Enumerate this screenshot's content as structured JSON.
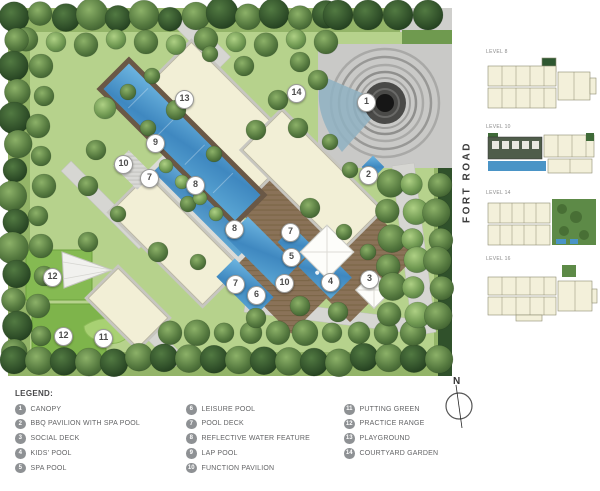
{
  "palette": {
    "pool_blue": "#4a94c8",
    "lawn_green": "#b6d28c",
    "tree_dark_green": "#2d4a26",
    "building_cream": "#f2efd6",
    "deck_brown": "#8a7258",
    "path_gray": "#d6d6d2",
    "legend_circle_gray": "#8e9194"
  },
  "plan": {
    "fort_road_label": "FORT ROAD",
    "markers": [
      {
        "n": "1"
      },
      {
        "n": "2"
      },
      {
        "n": "3"
      },
      {
        "n": "4"
      },
      {
        "n": "5"
      },
      {
        "n": "6"
      },
      {
        "n": "7"
      },
      {
        "n": "7"
      },
      {
        "n": "7"
      },
      {
        "n": "8"
      },
      {
        "n": "8"
      },
      {
        "n": "9"
      },
      {
        "n": "10"
      },
      {
        "n": "10"
      },
      {
        "n": "11"
      },
      {
        "n": "12"
      },
      {
        "n": "12"
      },
      {
        "n": "13"
      },
      {
        "n": "14"
      }
    ]
  },
  "floorplans": {
    "items": [
      {
        "label": "LEVEL 8"
      },
      {
        "label": "LEVEL 10"
      },
      {
        "label": "LEVEL 14"
      },
      {
        "label": "LEVEL 16"
      }
    ]
  },
  "legend": {
    "title": "LEGEND:",
    "items": [
      {
        "num": "1",
        "label": "CANOPY"
      },
      {
        "num": "2",
        "label": "BBQ PAVILION WITH SPA POOL"
      },
      {
        "num": "3",
        "label": "SOCIAL DECK"
      },
      {
        "num": "4",
        "label": "KIDS' POOL"
      },
      {
        "num": "5",
        "label": "SPA POOL"
      },
      {
        "num": "6",
        "label": "LEISURE POOL"
      },
      {
        "num": "7",
        "label": "POOL DECK"
      },
      {
        "num": "8",
        "label": "REFLECTIVE WATER FEATURE"
      },
      {
        "num": "9",
        "label": "LAP POOL"
      },
      {
        "num": "10",
        "label": "FUNCTION PAVILION"
      },
      {
        "num": "11",
        "label": "PUTTING GREEN"
      },
      {
        "num": "12",
        "label": "PRACTICE RANGE"
      },
      {
        "num": "13",
        "label": "PLAYGROUND"
      },
      {
        "num": "14",
        "label": "COURTYARD GARDEN"
      }
    ]
  },
  "compass": {
    "north": "N"
  }
}
